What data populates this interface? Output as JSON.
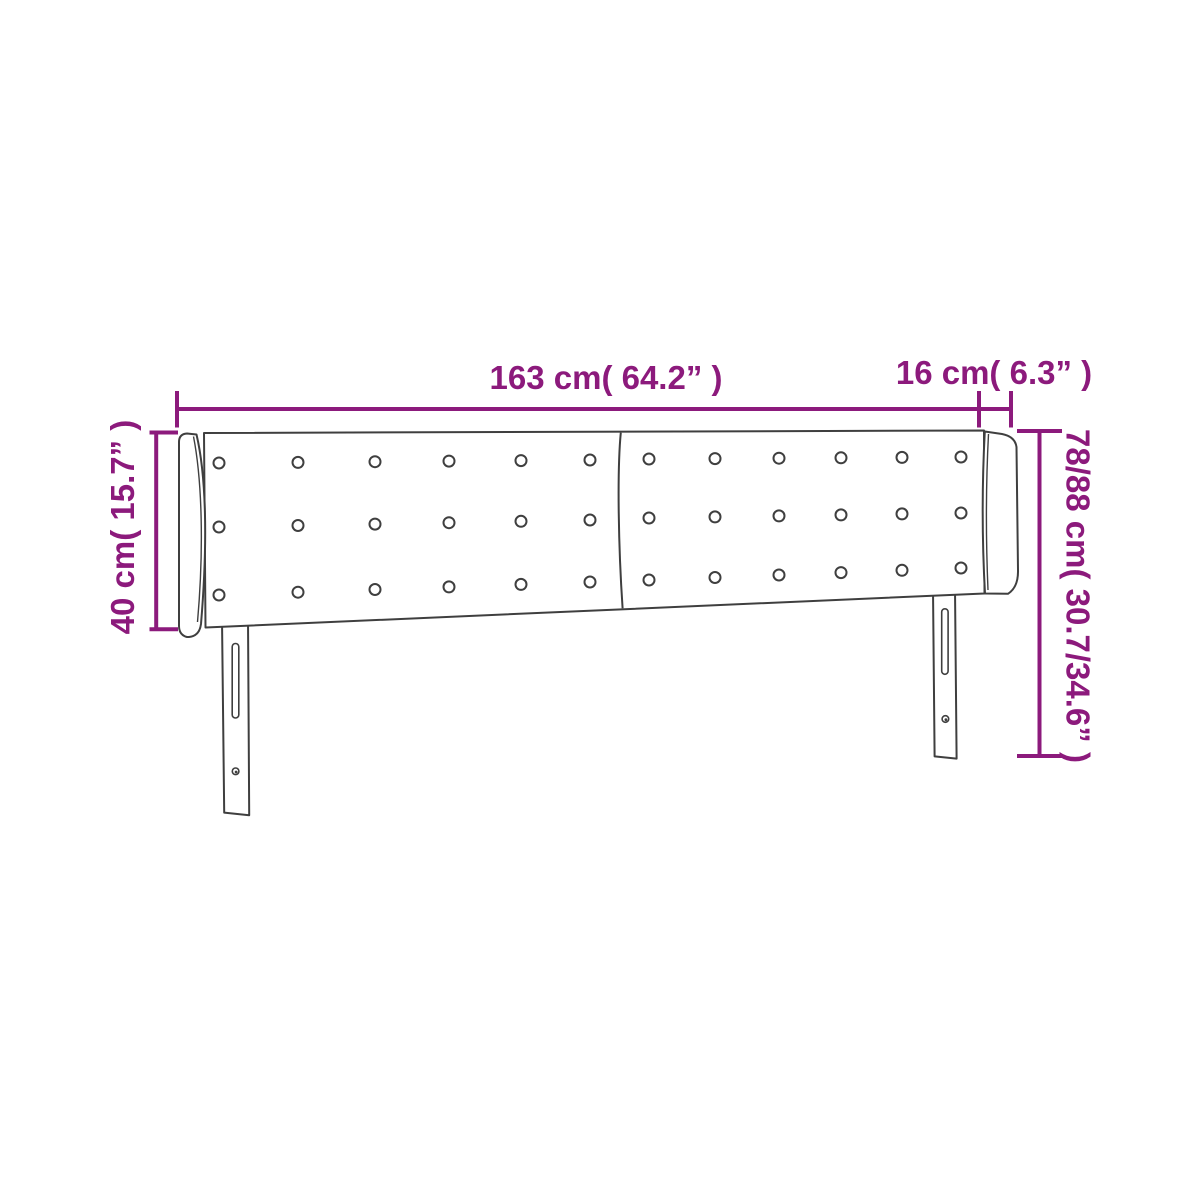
{
  "diagram": {
    "name": "Headboard with ears — dimension diagram",
    "colors": {
      "accent": "#8C1A7C",
      "outline": "#3F3F3F",
      "fill": "#ffffff"
    },
    "labels": {
      "width": "163 cm( 64.2” )",
      "ear_depth": "16 cm( 6.3” )",
      "headboard_height": "40 cm( 15.7” )",
      "total_height": "78/88 cm( 30.7/34.6” )"
    },
    "headboard": {
      "panels": 2,
      "button_rows": 3,
      "button_cols_per_panel": 6,
      "legs": 2
    }
  }
}
